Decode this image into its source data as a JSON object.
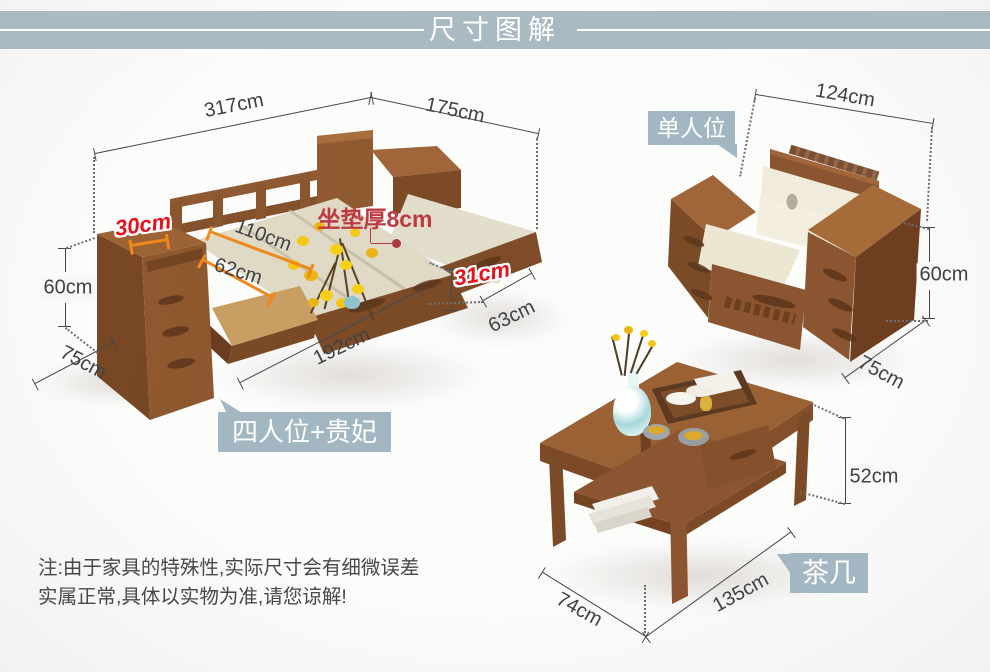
{
  "header": {
    "title": "尺寸图解"
  },
  "colors": {
    "header_bg": "#a9bac3",
    "badge_bg": "#a2b7c1",
    "dim_text": "#3f4145",
    "orange_line": "#f0891c",
    "red_dim": "#e8121d",
    "maroon_dim": "#bd3a43",
    "wood_dark": "#7b4a27",
    "wood_mid": "#8a5530",
    "wood_light": "#9d6435",
    "cushion": "#e0dbc8"
  },
  "items": [
    {
      "id": "sofa",
      "badge": "四人位+贵妃",
      "dimensions": [
        "317cm",
        "175cm",
        "30cm",
        "110cm",
        "62cm",
        "60cm",
        "75cm",
        "192cm",
        "63cm",
        "31cm"
      ],
      "cushion_note": "坐垫厚8cm"
    },
    {
      "id": "armchair",
      "badge": "单人位",
      "dimensions": [
        "124cm",
        "60cm",
        "75cm"
      ]
    },
    {
      "id": "tea_table",
      "badge": "茶几",
      "dimensions": [
        "52cm",
        "74cm",
        "135cm"
      ]
    }
  ],
  "badges": {
    "sofa": "四人位+贵妃",
    "chair": "单人位",
    "table": "茶几"
  },
  "note": {
    "line1": "注:由于家具的特殊性,实际尺寸会有细微误差",
    "line2": "实属正常,具体以实物为准,请您谅解!"
  },
  "labels": [
    {
      "name": "sofa-total-width",
      "text": "317cm",
      "x": 234,
      "y": 106,
      "rot": -11,
      "style": ""
    },
    {
      "name": "sofa-chaise-length",
      "text": "175cm",
      "x": 455,
      "y": 111,
      "rot": 12,
      "style": ""
    },
    {
      "name": "sofa-armrest-width",
      "text": "30cm",
      "x": 143,
      "y": 225,
      "rot": -8,
      "style": "red"
    },
    {
      "name": "sofa-bed-width",
      "text": "110cm",
      "x": 263,
      "y": 236,
      "rot": 20,
      "style": ""
    },
    {
      "name": "sofa-seat-depth",
      "text": "62cm",
      "x": 238,
      "y": 272,
      "rot": 17,
      "style": ""
    },
    {
      "name": "cushion-thickness",
      "text": "坐垫厚8cm",
      "x": 375,
      "y": 217,
      "rot": 0,
      "style": "maroon"
    },
    {
      "name": "sofa-armrest-height",
      "text": "60cm",
      "x": 68,
      "y": 288,
      "rot": 0,
      "style": "bg"
    },
    {
      "name": "sofa-armrest-depth",
      "text": "75cm",
      "x": 83,
      "y": 363,
      "rot": 28,
      "style": ""
    },
    {
      "name": "sofa-front-length",
      "text": "192cm",
      "x": 342,
      "y": 347,
      "rot": -26,
      "style": ""
    },
    {
      "name": "chaise-width",
      "text": "63cm",
      "x": 512,
      "y": 317,
      "rot": -26,
      "style": ""
    },
    {
      "name": "chaise-platform-height",
      "text": "31cm",
      "x": 482,
      "y": 274,
      "rot": -10,
      "style": "red"
    },
    {
      "name": "armchair-width",
      "text": "124cm",
      "x": 845,
      "y": 96,
      "rot": 10,
      "style": ""
    },
    {
      "name": "armchair-height",
      "text": "60cm",
      "x": 944,
      "y": 275,
      "rot": 0,
      "style": "bg"
    },
    {
      "name": "armchair-depth",
      "text": "75cm",
      "x": 881,
      "y": 373,
      "rot": 28,
      "style": ""
    },
    {
      "name": "table-height",
      "text": "52cm",
      "x": 874,
      "y": 477,
      "rot": 0,
      "style": "bg"
    },
    {
      "name": "table-depth",
      "text": "74cm",
      "x": 579,
      "y": 610,
      "rot": 29,
      "style": ""
    },
    {
      "name": "table-length",
      "text": "135cm",
      "x": 741,
      "y": 593,
      "rot": -29,
      "style": ""
    }
  ]
}
